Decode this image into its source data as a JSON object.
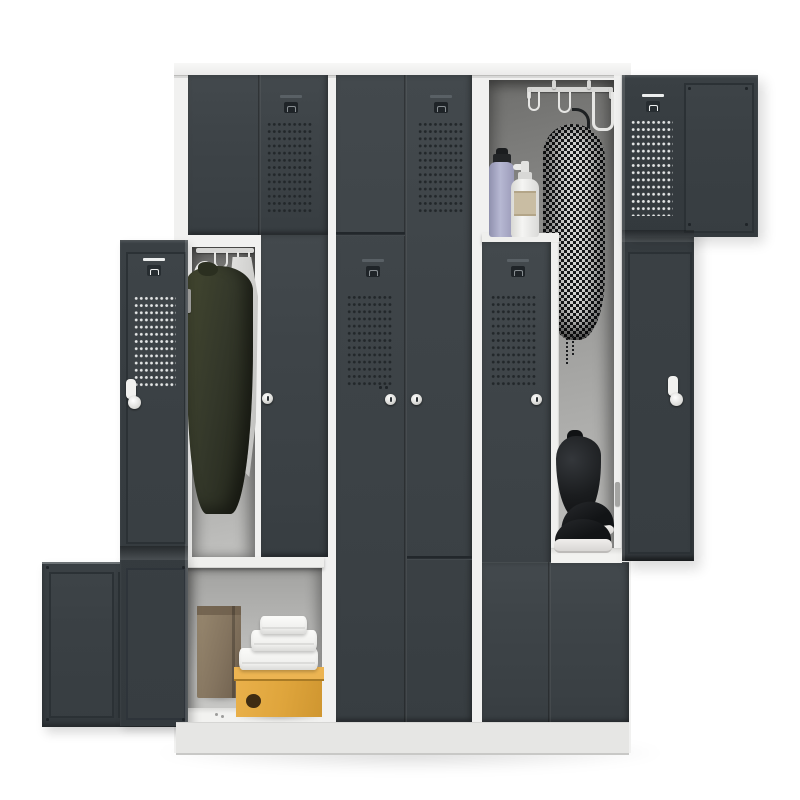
{
  "image": {
    "type": "product-photo",
    "subject": "Z-door steel clothes locker, 3 columns with 6 Z-shaped compartments; column 1 lower door and column 3 upper door open",
    "background": "#ffffff"
  },
  "colors": {
    "bg": "#ffffff",
    "frame": "#f1f1f0",
    "plinth": "#e6e6e4",
    "door": "#3e4448",
    "door-inner": "#363c40",
    "hardware": "#eceeee",
    "interior-wall": "#9b9b99",
    "jacket-olive": "#34382a",
    "towel-white": "#f2f2f0",
    "coat-dark": "#17191b",
    "coat-light": "#d4d4d2",
    "bottle-lavender": "#a7a8c6",
    "bottle-pump": "#f0f0ee",
    "label": "#c9bda3",
    "gym-bag": "#1a1c1e",
    "sneaker-sole": "#eceae8",
    "paper-bag": "#84745f",
    "shoebox-yellow": "#dfa53c"
  },
  "cabinet": {
    "columns": 3,
    "doors_per_column": 2,
    "door_style": "Z-door",
    "open_doors": [
      "column-1-lower",
      "column-3-upper"
    ],
    "closed_doors": [
      "column-1-upper",
      "column-2-upper",
      "column-2-lower",
      "column-3-lower"
    ],
    "hardware": [
      "recessed handles",
      "cam locks",
      "ventilation perforation"
    ]
  },
  "contents": {
    "column1_upper_compartment": [
      "olive jacket on hook",
      "white towel on hanger",
      "wire hangers",
      "hanging rail"
    ],
    "column1_lower_compartment": [
      "kraft paper bag",
      "stack of three folded white towels",
      "mustard-yellow shoebox"
    ],
    "column3_upper_compartment": [
      "ceiling hook rail with s-hooks",
      "lavender sports bottle",
      "white pump bottle",
      "black-and-white houndstooth coat on hanger",
      "black drawstring gym bag",
      "black sneakers with white soles"
    ]
  }
}
